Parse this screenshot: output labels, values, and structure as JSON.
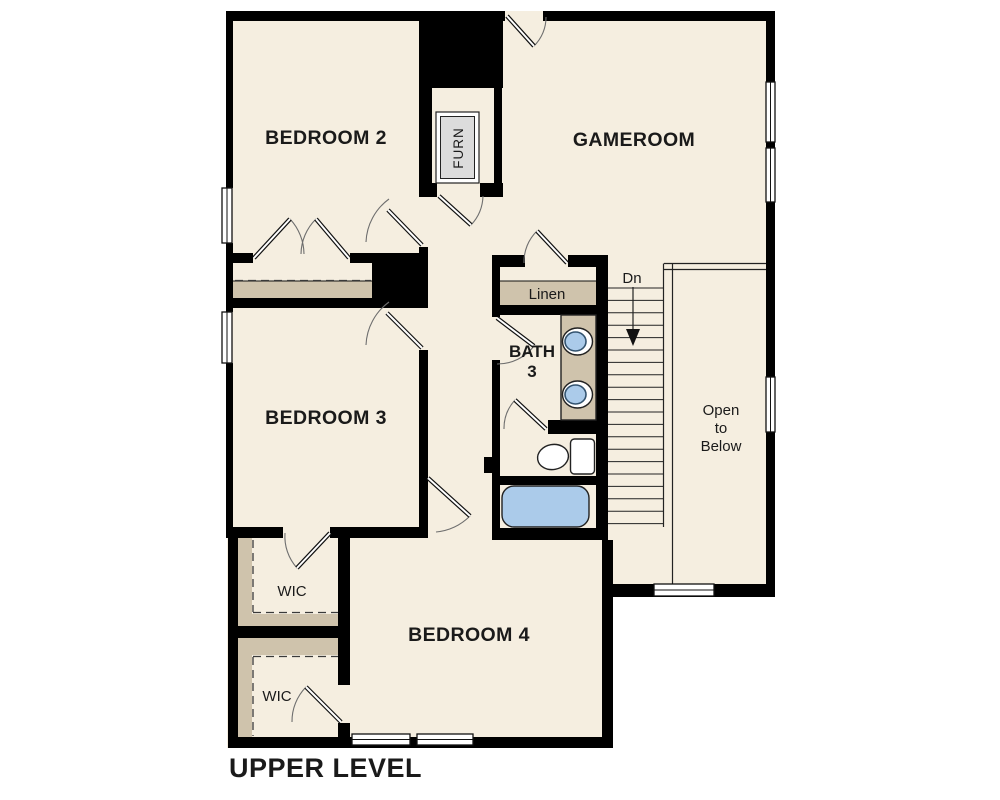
{
  "title": "UPPER LEVEL",
  "rooms": {
    "bedroom2": "BEDROOM 2",
    "gameroom": "GAMEROOM",
    "bedroom3": "BEDROOM 3",
    "bedroom4": "BEDROOM 4"
  },
  "bath": {
    "line1": "BATH",
    "line2": "3"
  },
  "closets": {
    "linen": "Linen",
    "wic_upper": "WIC",
    "wic_lower": "WIC"
  },
  "equipment": {
    "furnace": "FURN"
  },
  "stairs": {
    "direction_label": "Dn",
    "tread_count": 20
  },
  "open_to_below": {
    "line1": "Open",
    "line2": "to",
    "line3": "Below"
  },
  "colors": {
    "background": "#ffffff",
    "floor": "#f5eee0",
    "wall": "#000000",
    "shelf_tan": "#cfc3ac",
    "fixture_blue": "#abcbea",
    "fixture_blue_dark": "#33536f",
    "furnace_gray": "#dcdcdc",
    "label": "#1a1a1a"
  }
}
